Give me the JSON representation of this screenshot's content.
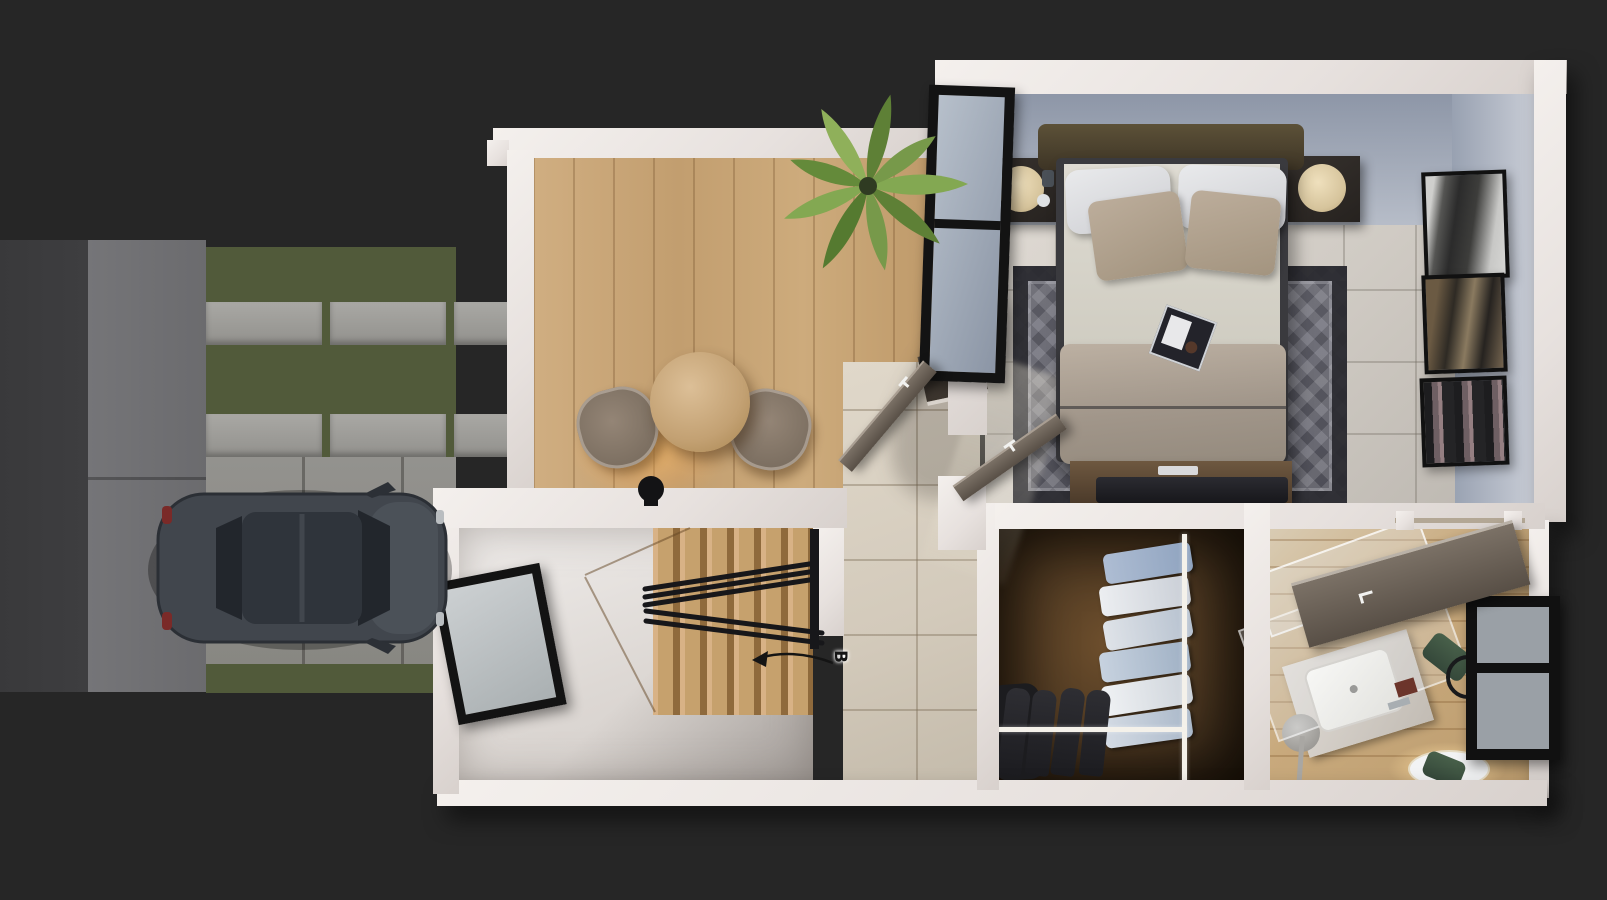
{
  "scene": {
    "title": "3d-floor-plan-top-down-render",
    "annotation": {
      "label": "B",
      "arrow_direction": "points-left-toward-staircase"
    },
    "rooms": [
      {
        "name": "dining-area",
        "floor": "light-wood-planks",
        "items": [
          "round-dining-table",
          "dining-chair",
          "dining-chair",
          "table-lamp",
          "palm-plant",
          "wall-shelf"
        ]
      },
      {
        "name": "staircase",
        "floor": "light-wood",
        "items": [
          "wood-steps",
          "black-metal-railing"
        ]
      },
      {
        "name": "hallway",
        "floor": "beige-ceramic-tiles",
        "items": [
          "open-door",
          "open-door"
        ]
      },
      {
        "name": "garage-room",
        "floor": "plain-light-concrete",
        "items": [
          "window"
        ]
      },
      {
        "name": "bedroom",
        "floor": "light-gray-tiles",
        "items": [
          "double-bed",
          "headboard",
          "nightstand-left",
          "nightstand-right",
          "round-lamp",
          "round-lamp",
          "geometric-rug",
          "media-console",
          "breakfast-tray",
          "window",
          "wall-art",
          "wall-art",
          "wall-art"
        ]
      },
      {
        "name": "walk-in-closet",
        "floor": "dark-wood",
        "items": [
          "hanging-shirts",
          "hanging-jackets",
          "boots",
          "white-hanging-rods"
        ]
      },
      {
        "name": "bathroom",
        "floor": "wood-planks",
        "items": [
          "glass-shower-screen",
          "marble-counter",
          "vessel-sink",
          "faucet",
          "round-mirror-glow",
          "towel-ring",
          "green-towel",
          "green-towel",
          "floor-stand",
          "sliding-door",
          "window"
        ]
      }
    ],
    "exterior": [
      {
        "name": "road",
        "surface": "dark-asphalt"
      },
      {
        "name": "sidewalk",
        "surface": "gray-concrete"
      },
      {
        "name": "front-yard",
        "surface": "grass-with-concrete-pavers"
      },
      {
        "name": "driveway",
        "surface": "concrete-slabs",
        "items": [
          "parked-suv-dark-gray"
        ]
      }
    ],
    "colors": {
      "background": "#262626",
      "wall": "#e7e1de",
      "grass": "#515a3a",
      "driveway": "#8e8d8a",
      "tile_hall": "#d3cabb",
      "tile_bedroom": "#d0cbc4",
      "wood_floor": "#c8a676",
      "closet_wood": "#4a3620",
      "rug": "#4e4e57",
      "bed_duvet": "#a1968a",
      "bed_pillow_accent": "#a3947f",
      "nightstand": "#26221f",
      "car_body": "#41464d",
      "railing": "#17171a",
      "door": "#6b6158",
      "towel": "#35483a",
      "lamp_glow": "#ffb460"
    }
  }
}
